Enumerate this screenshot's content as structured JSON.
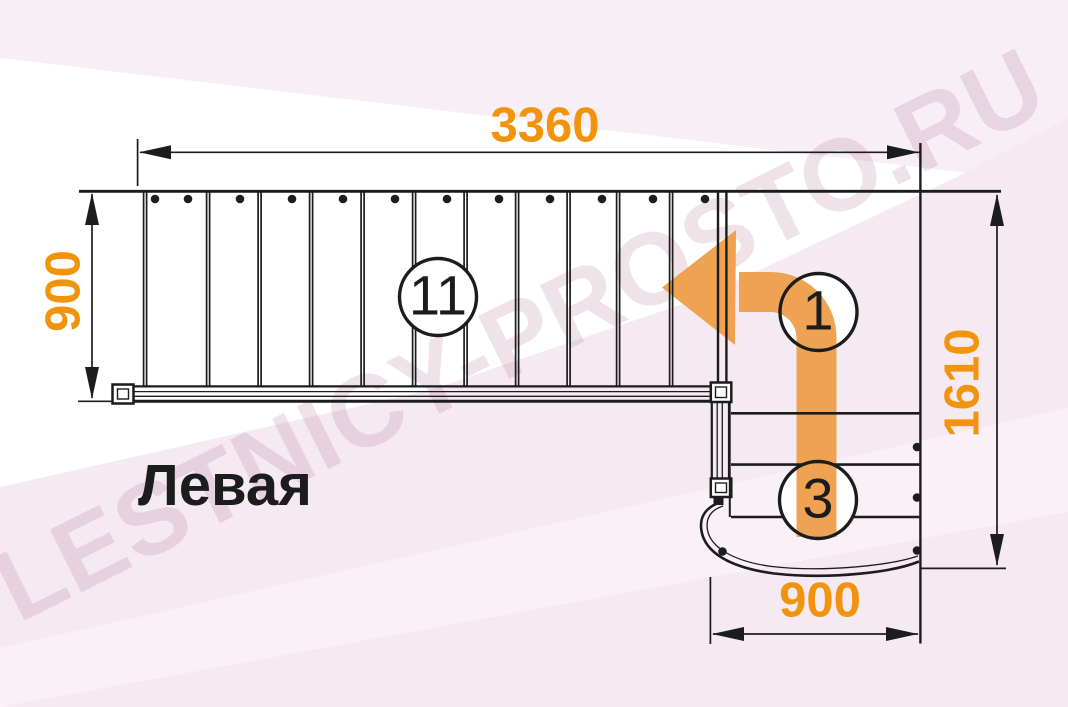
{
  "watermark": {
    "text": "LESTNICY-PROSTO.RU"
  },
  "plan": {
    "orientation_label": "Левая",
    "step_counts": {
      "upper_flight": "11",
      "turn": "1",
      "lower_flight": "3"
    }
  },
  "dimensions": {
    "top_width": "3360",
    "left_depth": "900",
    "right_depth": "1610",
    "bottom_width": "900"
  },
  "colors": {
    "dimension_text": "#F2930D",
    "direction_arrow": "#EFA251",
    "linework": "#1C1C1C",
    "background_tint": "#F6EAF2",
    "watermark_text": "#EEE0E7"
  }
}
